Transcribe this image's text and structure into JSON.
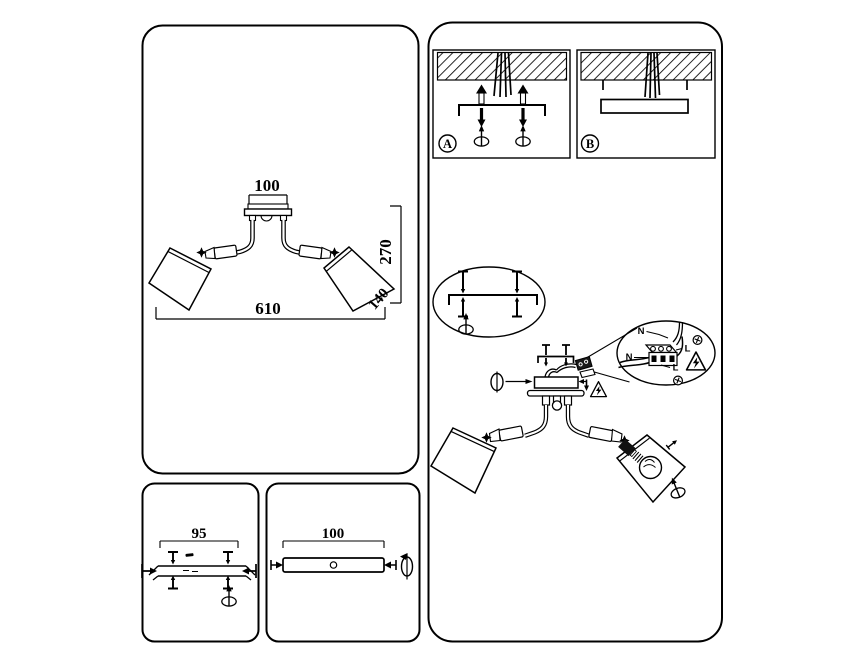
{
  "colors": {
    "line": "#000000",
    "background": "#ffffff"
  },
  "spec_panel": {
    "dim_canopy": "100",
    "dim_drop": "270",
    "dim_width": "610",
    "dim_shade": "140"
  },
  "bracket_panel": {
    "dim_holes": "95"
  },
  "plate_panel": {
    "dim_plate": "100"
  },
  "install_panel": {
    "steps": {
      "a": "A",
      "b": "B"
    },
    "wiring": {
      "neutral_top": "N",
      "line_right": "L",
      "neutral_left": "N",
      "line_bottom": "L"
    }
  }
}
